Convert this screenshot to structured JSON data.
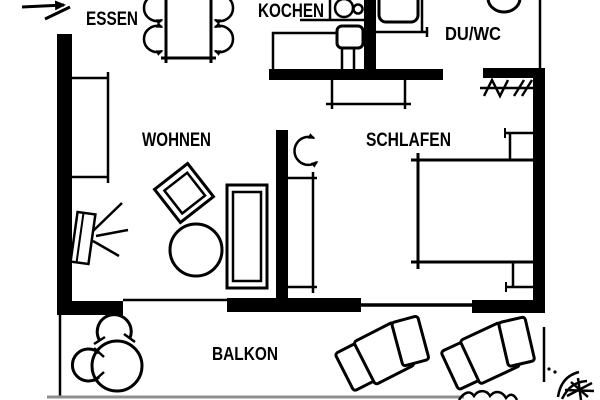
{
  "plan": {
    "kind": "apartment-floor-plan",
    "language": "de",
    "rooms": {
      "essen": "ESSEN",
      "kochen": "KOCHEN",
      "duwc": "DU/WC",
      "wohnen": "WOHNEN",
      "schlafen": "SCHLAFEN",
      "balkon": "BALKON"
    },
    "colors": {
      "ink": "#000000",
      "background": "#ffffff",
      "terrace_edge": "#8f8f8f"
    },
    "symbols": [
      "entrance-arrow",
      "dining-table",
      "dining-chair",
      "sideboard",
      "stove-hob",
      "kitchen-counter",
      "kitchen-sink-unit",
      "shower-tray",
      "wc-toilet",
      "coat-rack-hatching",
      "hall-closet",
      "door-swing-arrow",
      "wardrobe",
      "double-bed",
      "nightstand",
      "tv-with-rays",
      "armchair",
      "coffee-table",
      "sofa",
      "balcony-table",
      "balcony-chair",
      "sun-lounger",
      "plant-scribble",
      "balcony-railing"
    ]
  }
}
